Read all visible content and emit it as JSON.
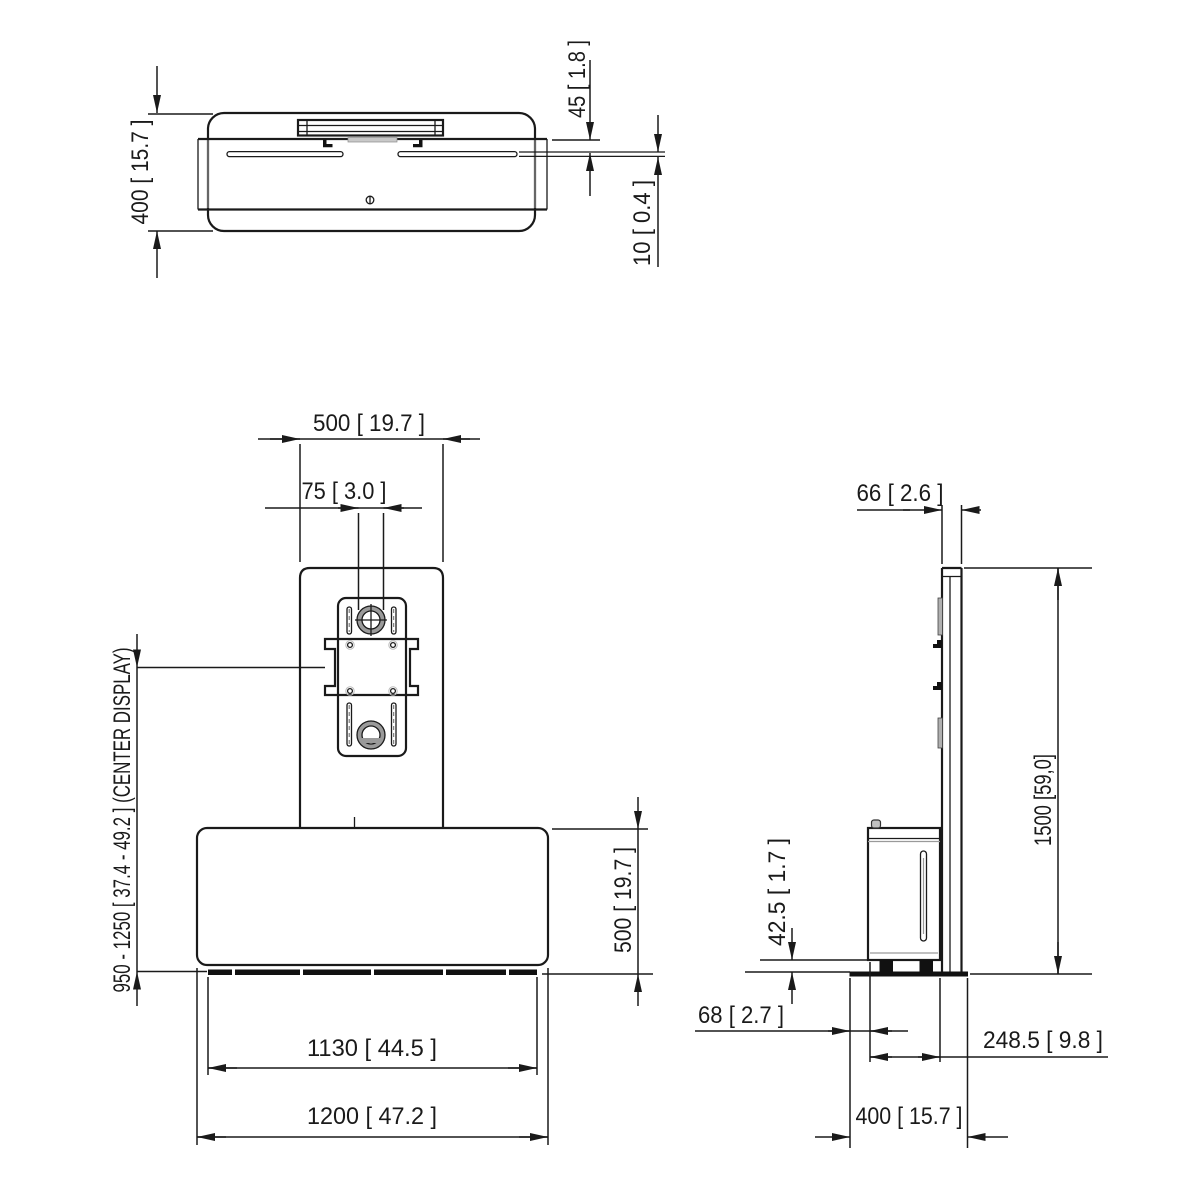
{
  "drawing": {
    "background": "#ffffff",
    "line_color": "#1a1a1a",
    "accent_gray": "#9a9a9a"
  },
  "dims": {
    "top": {
      "depth": "400 [ 15.7 ]",
      "panel_offset": "45 [ 1.8 ]",
      "panel_thickness": "10 [ 0.4 ]"
    },
    "front": {
      "column_width": "500 [ 19.7 ]",
      "grommet_diameter": "75 [ 3.0 ]",
      "display_center_range": "950 - 1250 [ 37.4 - 49.2 ] (CENTER DISPLAY)",
      "cabinet_height": "500 [ 19.7 ]",
      "base_width": "1130 [ 44.5 ]",
      "total_width": "1200 [ 47.2 ]"
    },
    "side": {
      "column_depth": "66 [ 2.6 ]",
      "total_height": "1500 [59,0]",
      "foot_height": "42.5 [ 1.7 ]",
      "rear_offset": "68 [ 2.7 ]",
      "cabinet_depth": "248.5 [ 9.8 ]",
      "base_depth": "400 [ 15.7 ]"
    }
  }
}
